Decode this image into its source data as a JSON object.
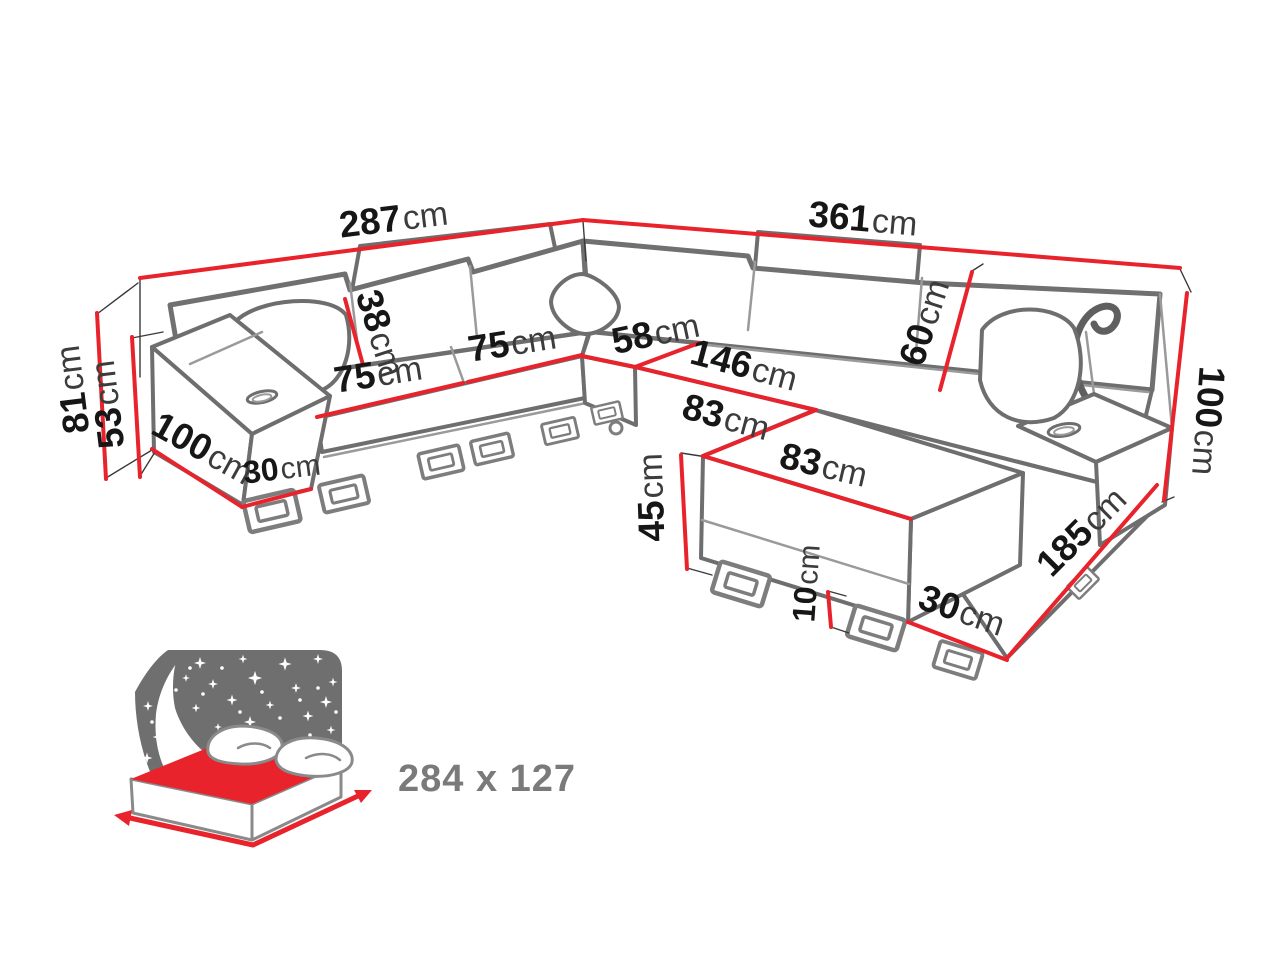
{
  "dims": {
    "d287": {
      "num": "287",
      "unit": "cm"
    },
    "d361": {
      "num": "361",
      "unit": "cm"
    },
    "d81": {
      "num": "81",
      "unit": "cm"
    },
    "d53": {
      "num": "53",
      "unit": "cm"
    },
    "d100_left": {
      "num": "100",
      "unit": "cm"
    },
    "d30_left": {
      "num": "30",
      "unit": "cm"
    },
    "d75_seat1": {
      "num": "75",
      "unit": "cm"
    },
    "d38": {
      "num": "38",
      "unit": "cm"
    },
    "d75_seat2": {
      "num": "75",
      "unit": "cm"
    },
    "d58": {
      "num": "58",
      "unit": "cm"
    },
    "d146": {
      "num": "146",
      "unit": "cm"
    },
    "d60": {
      "num": "60",
      "unit": "cm"
    },
    "d83_side": {
      "num": "83",
      "unit": "cm"
    },
    "d83_front": {
      "num": "83",
      "unit": "cm"
    },
    "d45": {
      "num": "45",
      "unit": "cm"
    },
    "d10": {
      "num": "10",
      "unit": "cm"
    },
    "d30_right": {
      "num": "30",
      "unit": "cm"
    },
    "d185": {
      "num": "185",
      "unit": "cm"
    },
    "d100_right": {
      "num": "100",
      "unit": "cm"
    }
  },
  "sleeping_area": {
    "size_label": "284 x 127",
    "icon": "bed-with-starry-night-icon"
  },
  "colors": {
    "dimension_red": "#e8232b",
    "label_number": "#161616",
    "label_unit": "#3c3c3c",
    "sofa_outline": "#6e6e6e",
    "sky_gray": "#6f6f6f",
    "size_text_gray": "#7a7a7a"
  }
}
